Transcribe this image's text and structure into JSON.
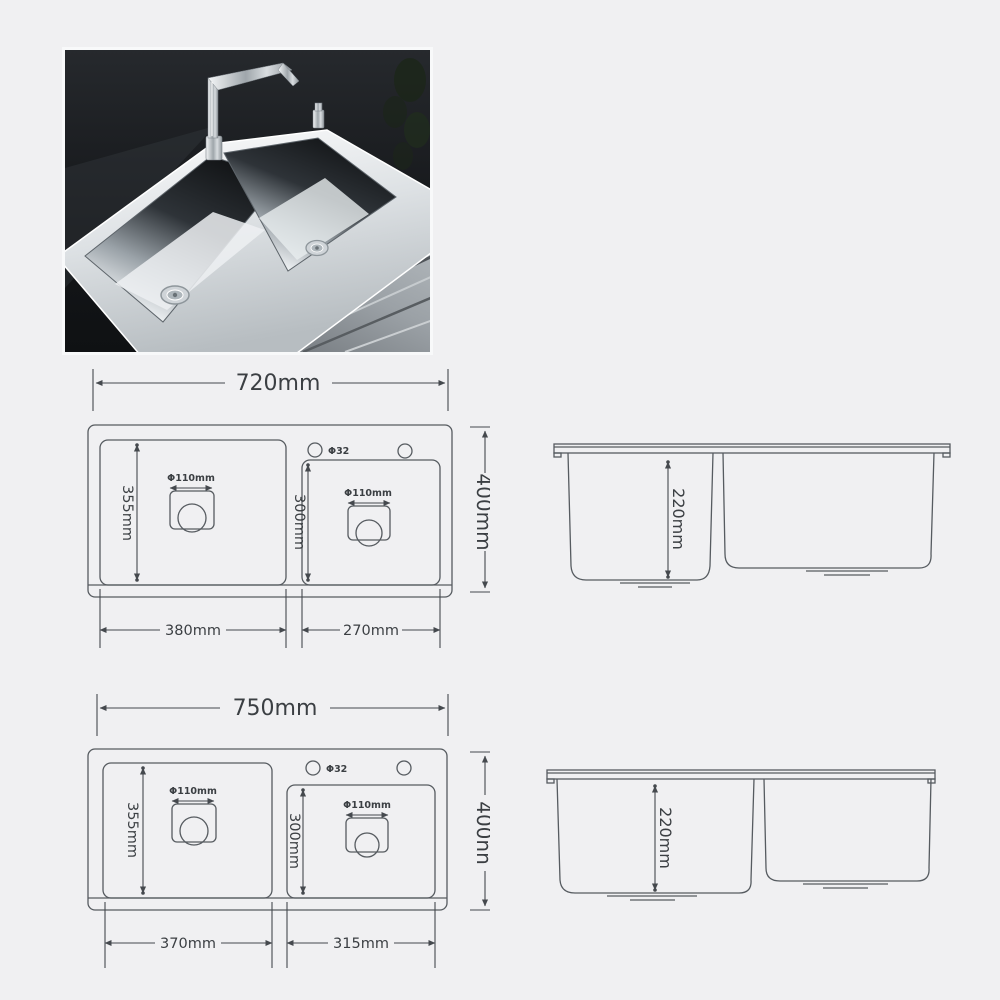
{
  "colors": {
    "background": "#f0f0f2",
    "line": "#565b60",
    "text": "#3b3f43",
    "photo_background": "#15171a",
    "steel": "#e9ecee",
    "counter": "#9aa0a5"
  },
  "diagrams": {
    "model_720": {
      "top_view": {
        "overall_width": "720mm",
        "overall_depth": "400mm",
        "faucet_hole": "Φ32",
        "left_bowl": {
          "width": "380mm",
          "length": "355mm",
          "drain": "Φ110mm"
        },
        "right_bowl": {
          "width": "270mm",
          "length": "300mm",
          "drain": "Φ110mm"
        }
      },
      "side_view": {
        "bowl_depth": "220mm"
      }
    },
    "model_750": {
      "top_view": {
        "overall_width": "750mm",
        "overall_depth": "400nn",
        "faucet_hole": "Φ32",
        "left_bowl": {
          "width": "370mm",
          "length": "355mm",
          "drain": "Φ110mm"
        },
        "right_bowl": {
          "width": "315mm",
          "length": "300mm",
          "drain": "Φ110mm"
        }
      },
      "side_view": {
        "bowl_depth": "220mm"
      }
    }
  }
}
